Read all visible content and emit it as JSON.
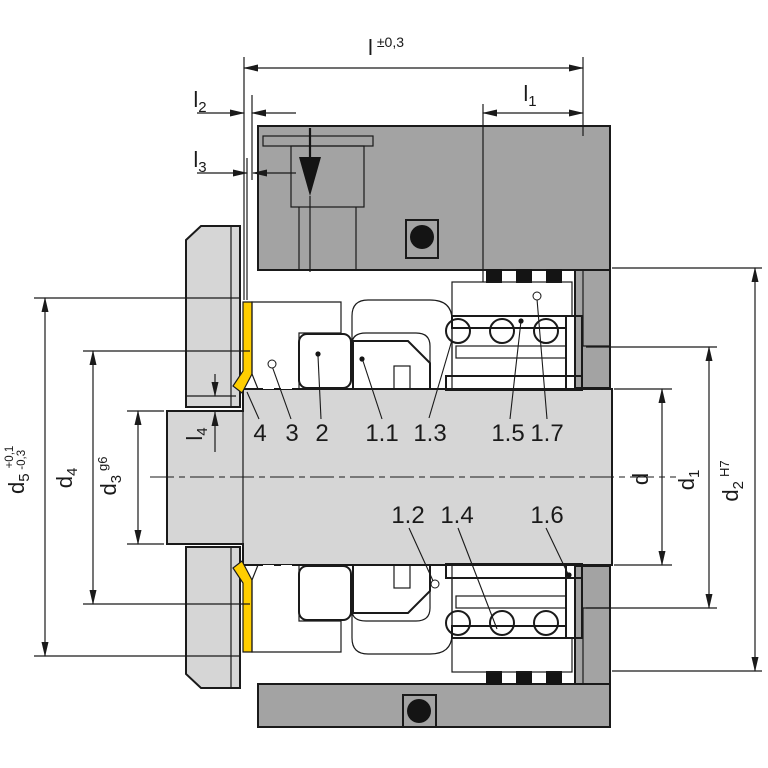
{
  "drawing": {
    "type": "mechanical-seal-cross-section-installation-drawing"
  },
  "dims": {
    "l": {
      "main": "l",
      "tol": "±0,3"
    },
    "l1": {
      "main": "l",
      "sub": "1"
    },
    "l2": {
      "main": "l",
      "sub": "2"
    },
    "l3": {
      "main": "l",
      "sub": "3"
    },
    "l4": {
      "main": "l",
      "sub": "4"
    },
    "d": {
      "main": "d"
    },
    "d1": {
      "main": "d",
      "sub": "1"
    },
    "d2": {
      "main": "d",
      "sub": "2",
      "fit": "H7"
    },
    "d3": {
      "main": "d",
      "sub": "3",
      "fit": "g6"
    },
    "d4": {
      "main": "d",
      "sub": "4"
    },
    "d5": {
      "main": "d",
      "sub": "5",
      "tol_plus": "+0,1",
      "tol_minus": "-0,3"
    }
  },
  "parts": {
    "top": [
      "4",
      "3",
      "2",
      "1.1",
      "1.3",
      "1.5",
      "1.7"
    ],
    "bottom": [
      "1.2",
      "1.4",
      "1.6"
    ]
  },
  "colors": {
    "housing_gray": "#a3a3a3",
    "steel_gray": "#d6d6d6",
    "elastomer_black": "#141414",
    "bellows_yellow": "#ffce00",
    "metal_blue": "#94b6d8",
    "face_blue": "#5d7bc0",
    "line": "#1a1a1a",
    "background": "#ffffff"
  }
}
